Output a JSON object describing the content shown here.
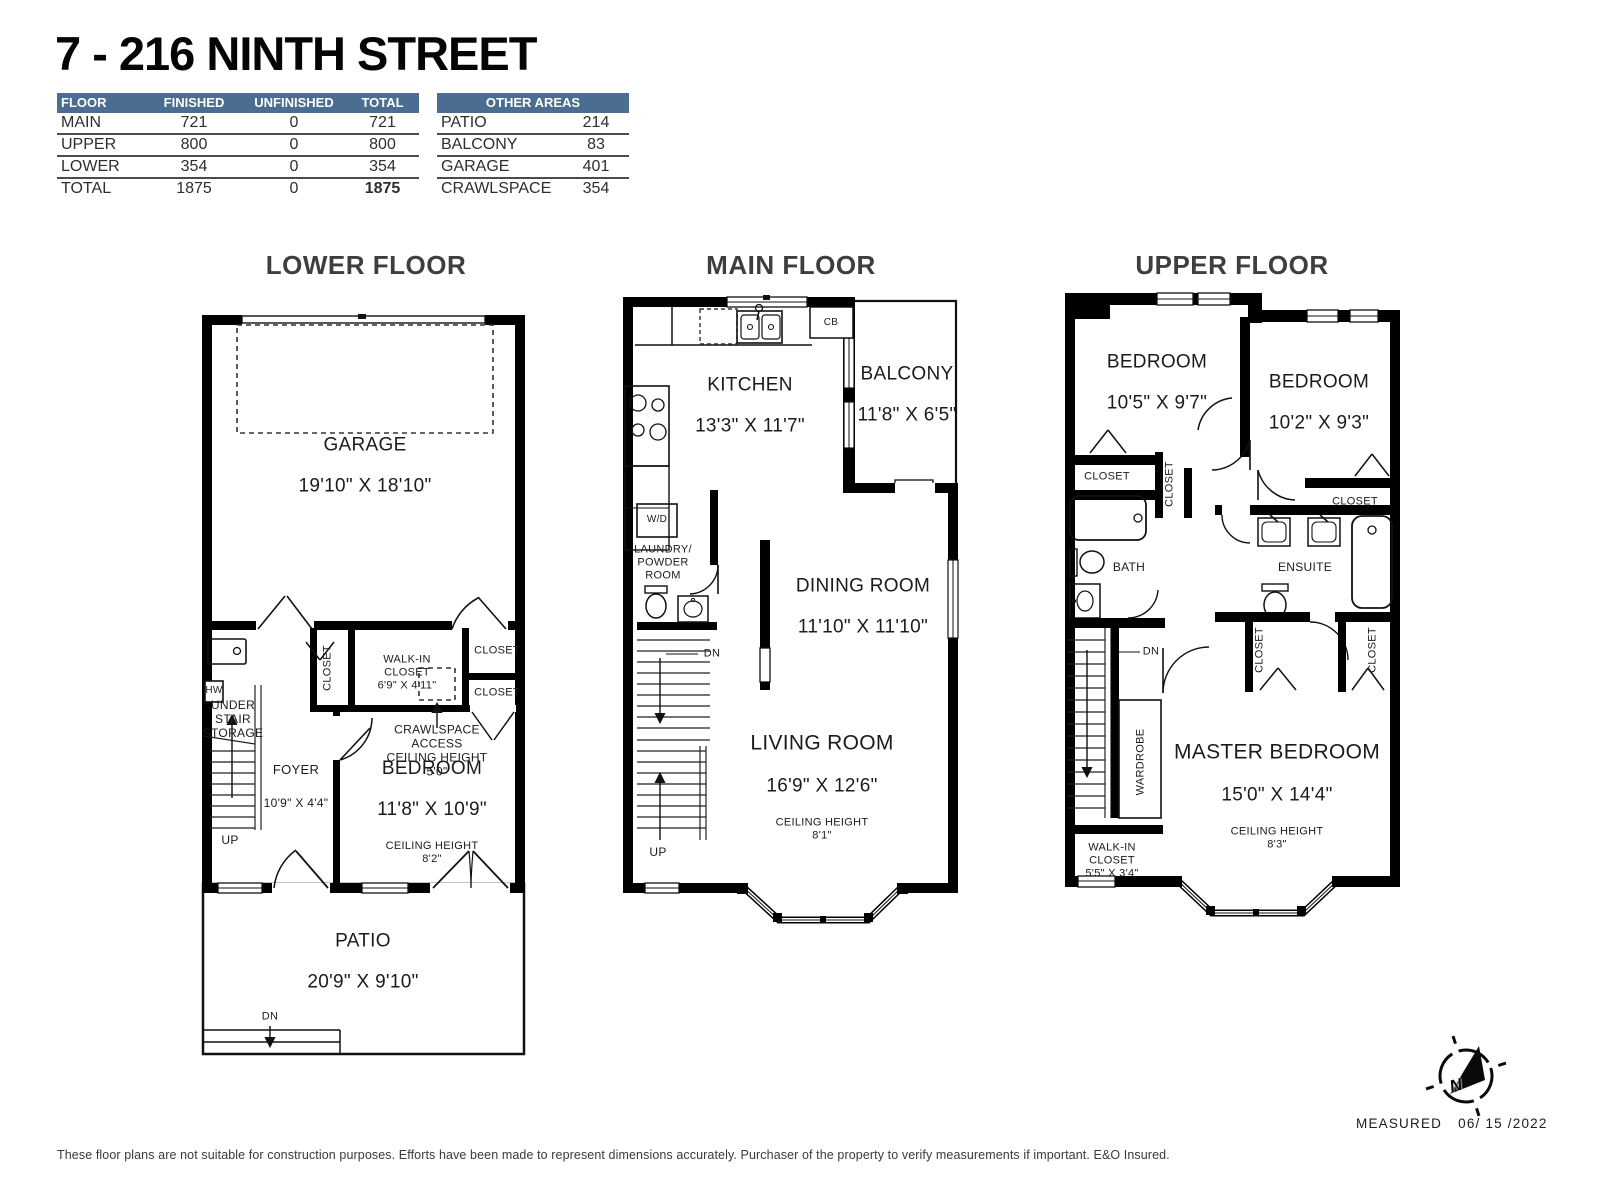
{
  "title": "7 - 216 NINTH STREET",
  "colors": {
    "header_blue": "#4a6d91",
    "wall": "#000000",
    "text": "#1e1e1e"
  },
  "area_table": {
    "headers": [
      "FLOOR",
      "FINISHED",
      "UNFINISHED",
      "TOTAL"
    ],
    "rows": [
      {
        "floor": "MAIN",
        "finished": "721",
        "unfinished": "0",
        "total": "721"
      },
      {
        "floor": "UPPER",
        "finished": "800",
        "unfinished": "0",
        "total": "800"
      },
      {
        "floor": "LOWER",
        "finished": "354",
        "unfinished": "0",
        "total": "354"
      },
      {
        "floor": "TOTAL",
        "finished": "1875",
        "unfinished": "0",
        "total": "1875"
      }
    ]
  },
  "other_areas": {
    "header": "OTHER AREAS",
    "rows": [
      {
        "name": "PATIO",
        "value": "214"
      },
      {
        "name": "BALCONY",
        "value": "83"
      },
      {
        "name": "GARAGE",
        "value": "401"
      },
      {
        "name": "CRAWLSPACE",
        "value": "354"
      }
    ]
  },
  "floors": {
    "lower": {
      "title": "LOWER FLOOR",
      "garage_name": "GARAGE",
      "garage_dims": "19'10\" X 18'10\"",
      "hw": "HW",
      "under_stair": [
        "UNDER",
        "STAIR",
        "STORAGE"
      ],
      "up": "UP",
      "dn": "DN",
      "foyer_name": "FOYER",
      "foyer_dims": "10'9\" X 4'4\"",
      "closet": "CLOSET",
      "walkin": [
        "WALK-IN",
        "CLOSET",
        "6'9\" X 4'11\""
      ],
      "crawlspace": [
        "CRAWLSPACE",
        "ACCESS",
        "CEILING HEIGHT",
        "5'0\""
      ],
      "bedroom_name": "BEDROOM",
      "bedroom_dims": "11'8\" X 10'9\"",
      "bedroom_ceiling": [
        "CEILING HEIGHT",
        "8'2\""
      ],
      "patio_name": "PATIO",
      "patio_dims": "20'9\" X 9'10\""
    },
    "main": {
      "title": "MAIN FLOOR",
      "kitchen_name": "KITCHEN",
      "kitchen_dims": "13'3\" X 11'7\"",
      "cb": "CB",
      "wd": "W/D",
      "laundry": [
        "LAUNDRY/",
        "POWDER",
        "ROOM"
      ],
      "balcony_name": "BALCONY",
      "balcony_dims": "11'8\" X 6'5\"",
      "dining_name": "DINING ROOM",
      "dining_dims": "11'10\" X 11'10\"",
      "living_name": "LIVING ROOM",
      "living_dims": "16'9\" X 12'6\"",
      "living_ceiling": [
        "CEILING HEIGHT",
        "8'1\""
      ],
      "dn": "DN",
      "up": "UP"
    },
    "upper": {
      "title": "UPPER FLOOR",
      "bedroom1_name": "BEDROOM",
      "bedroom1_dims": "10'5\" X 9'7\"",
      "bedroom2_name": "BEDROOM",
      "bedroom2_dims": "10'2\" X 9'3\"",
      "closet": "CLOSET",
      "bath": "BATH",
      "ensuite": "ENSUITE",
      "dn": "DN",
      "wardrobe": "WARDROBE",
      "walkin": [
        "WALK-IN",
        "CLOSET",
        "5'5\" X 3'4\""
      ],
      "master_name": "MASTER BEDROOM",
      "master_dims": "15'0\" X 14'4\"",
      "master_ceiling": [
        "CEILING HEIGHT",
        "8'3\""
      ]
    }
  },
  "footer": {
    "measured_label": "MEASURED",
    "measured_date": "06/ 15 /2022",
    "compass_n": "N",
    "compass_icon": "north-compass-icon",
    "disclaimer": "These floor plans are not suitable for construction purposes. Efforts have been made to represent dimensions accurately.  Purchaser of the property to verify measurements if important.  E&O Insured."
  }
}
